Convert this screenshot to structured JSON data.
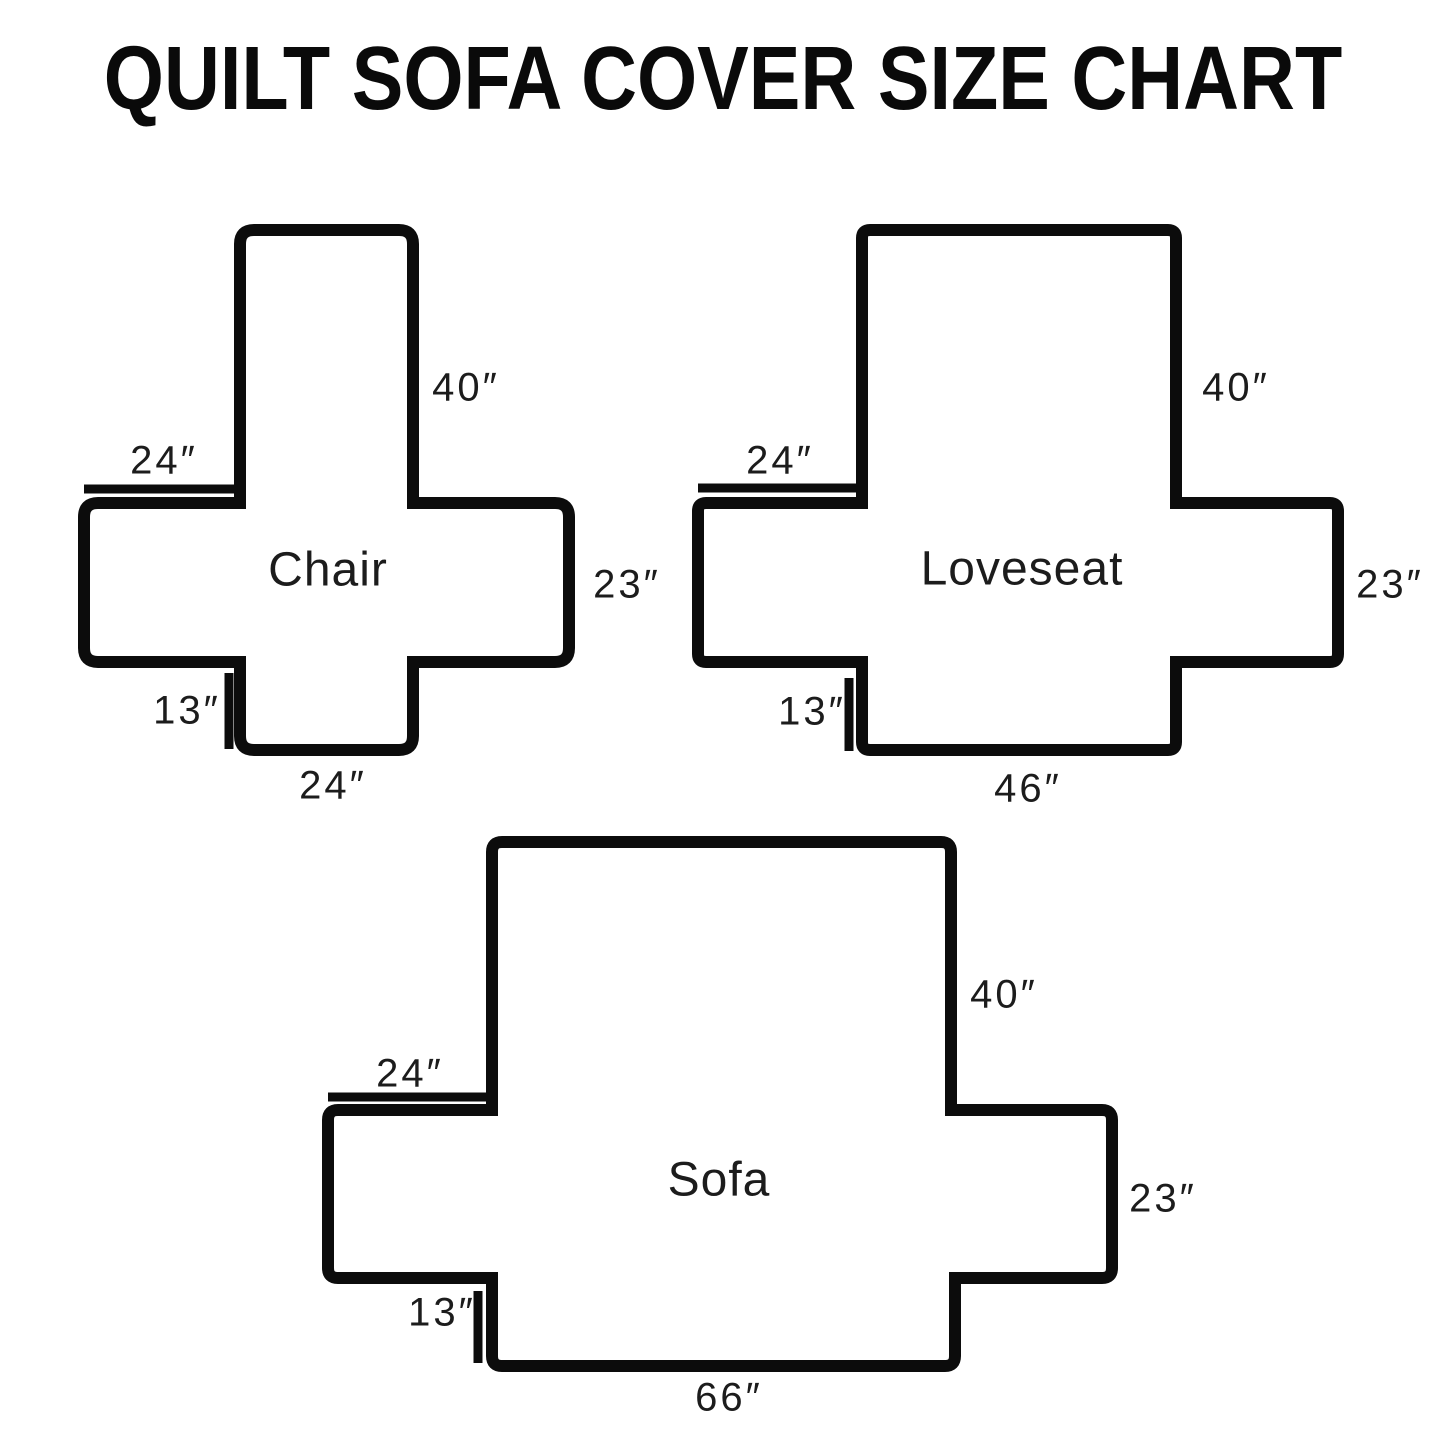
{
  "title": "QUILT SOFA COVER SIZE CHART",
  "diagrams": {
    "chair": {
      "name": "Chair",
      "back_height": "40″",
      "arm_top_width": "24″",
      "side_height": "23″",
      "tuck_flap_height": "13″",
      "seat_bottom_width": "24″"
    },
    "loveseat": {
      "name": "Loveseat",
      "back_height": "40″",
      "arm_top_width": "24″",
      "side_height": "23″",
      "tuck_flap_height": "13″",
      "seat_bottom_width": "46″"
    },
    "sofa": {
      "name": "Sofa",
      "back_height": "40″",
      "arm_top_width": "24″",
      "side_height": "23″",
      "tuck_flap_height": "13″",
      "seat_bottom_width": "66″"
    }
  }
}
